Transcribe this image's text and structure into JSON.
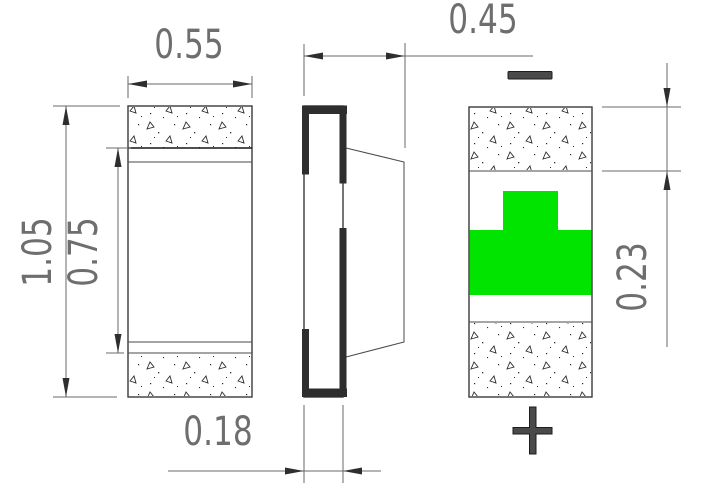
{
  "drawing": {
    "views": {
      "front": "front-view",
      "side": "side-view",
      "back": "back-view"
    }
  },
  "dimensions": {
    "front_width": "0.55",
    "front_total_height": "1.05",
    "front_body_height": "0.75",
    "side_total_depth": "0.45",
    "side_base_depth": "0.18",
    "back_terminal_height": "0.23"
  },
  "symbols": {
    "negative": "-",
    "positive": "+"
  },
  "colors": {
    "led_green": "#00e400",
    "outline": "#3a3a3a",
    "dimension_text": "#6e6e6e"
  }
}
